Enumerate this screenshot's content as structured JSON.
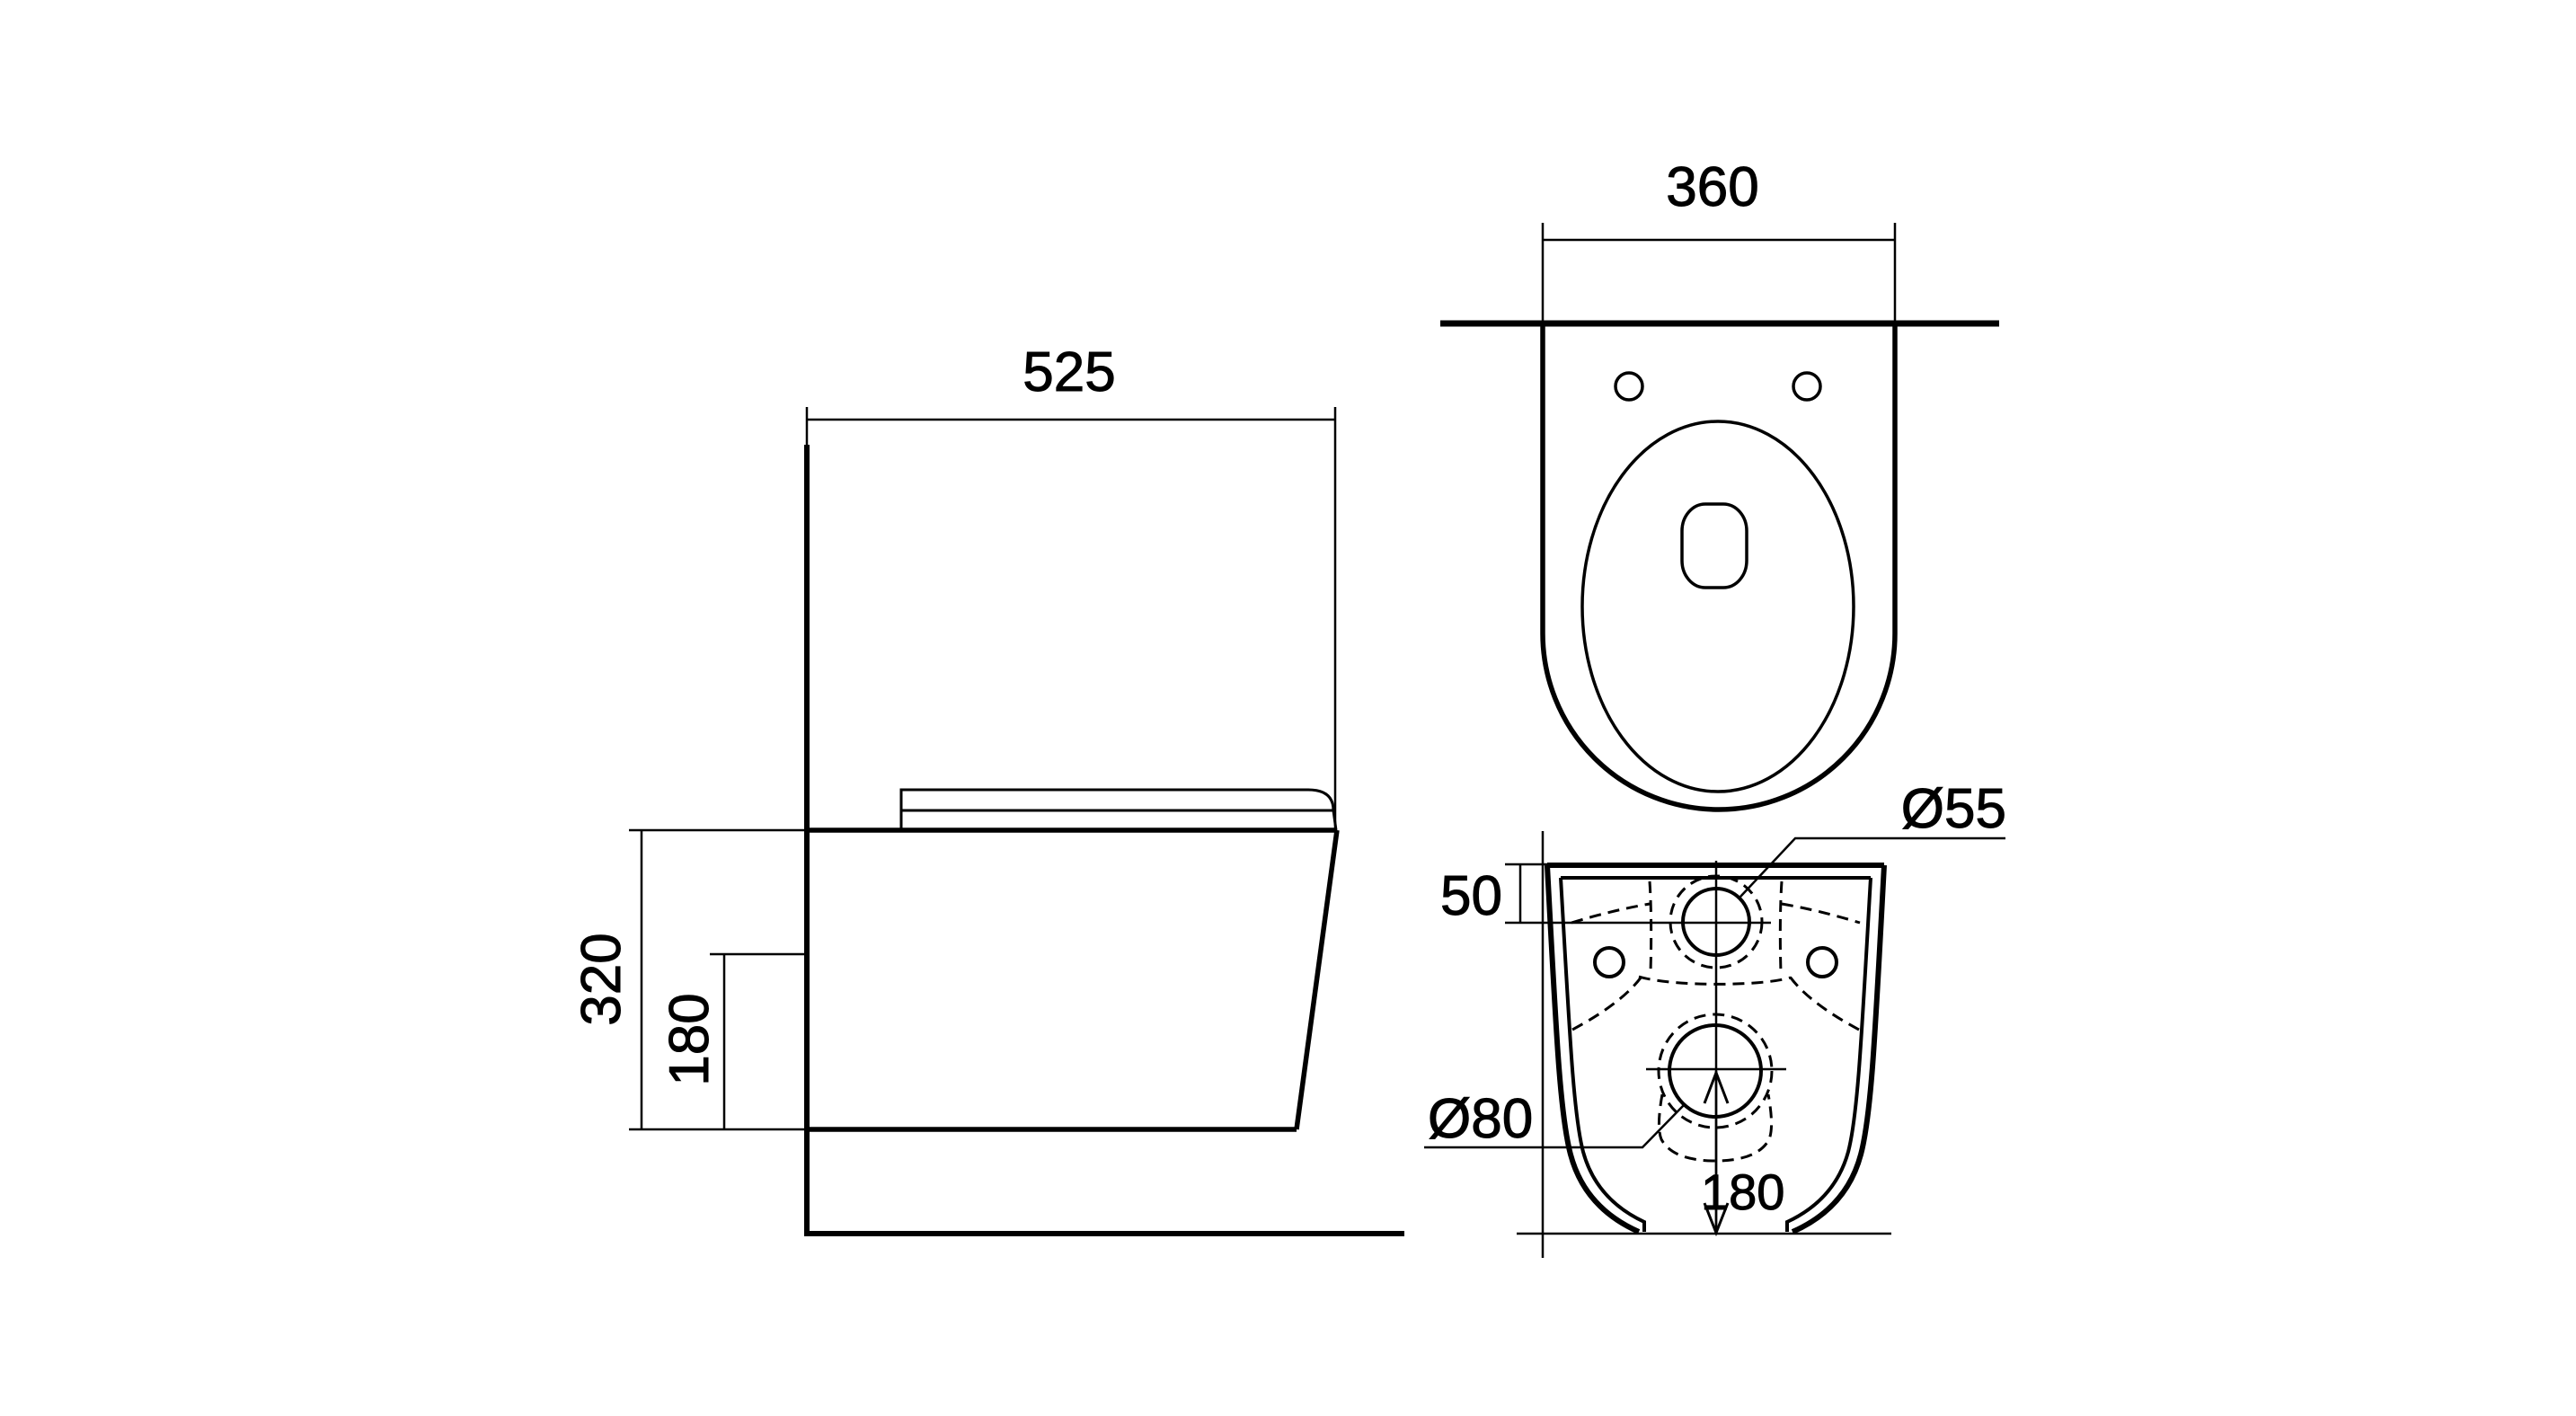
{
  "drawing": {
    "colors": {
      "line": "#000000",
      "background": "#ffffff"
    },
    "views": {
      "side": {
        "dimensions": {
          "depth": "525",
          "height": "320",
          "bowl_bottom_offset": "180"
        }
      },
      "top": {
        "dimensions": {
          "width": "360"
        }
      },
      "rear": {
        "dimensions": {
          "inlet_top_offset": "50",
          "inlet_diameter": "Ø55",
          "outlet_diameter": "Ø80",
          "outlet_center_height": "180"
        }
      }
    }
  }
}
